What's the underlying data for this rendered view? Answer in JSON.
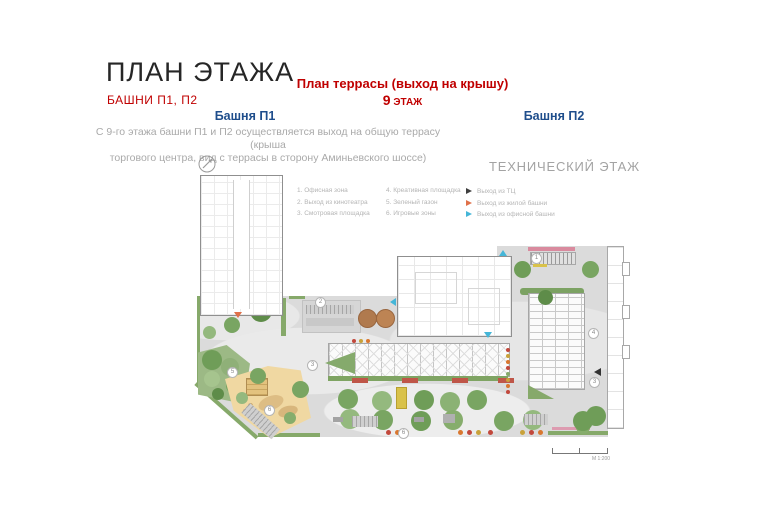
{
  "header": {
    "title": "ПЛАН ЭТАЖА",
    "subtitle": "БАШНИ П1, П2",
    "terrace_title": "План террасы (выход на крышу)",
    "floor_num": "9",
    "floor_word": " ЭТАЖ",
    "tower1": "Башня П1",
    "tower2": "Башня П2",
    "desc1": "С 9-го этажа башни П1 и П2 осуществляется выход на общую террасу (крыша",
    "desc2": "торгового центра, вид с террасы  в сторону Аминьевского шоссе)",
    "tech_floor": "ТЕХНИЧЕСКИЙ ЭТАЖ"
  },
  "legend": {
    "items_col1": [
      "1. Офисная зона",
      "2. Выход из кинотеатра",
      "3. Смотровая площадка"
    ],
    "items_col2": [
      "4. Креативная площадка",
      "5. Зеленый газон",
      "6. Игровые зоны"
    ],
    "exits": [
      {
        "label": "Выход из ТЦ",
        "color": "#3F3F3F"
      },
      {
        "label": "Выход из жилой башни",
        "color": "#E0714A"
      },
      {
        "label": "Выход из офисной башни",
        "color": "#45B6D8"
      }
    ]
  },
  "plan": {
    "scale_label": "М 1:200",
    "markers": [
      "2",
      "3",
      "5",
      "6",
      "6",
      "1",
      "4",
      "3"
    ]
  },
  "colors": {
    "accent_red": "#C00000",
    "accent_blue": "#1F4E8C",
    "muted_gray": "#A9A9A9",
    "terrace_gray": "#DBDBDB",
    "greenery": "#86A96A",
    "playground_sand": "#F0D8A2"
  }
}
